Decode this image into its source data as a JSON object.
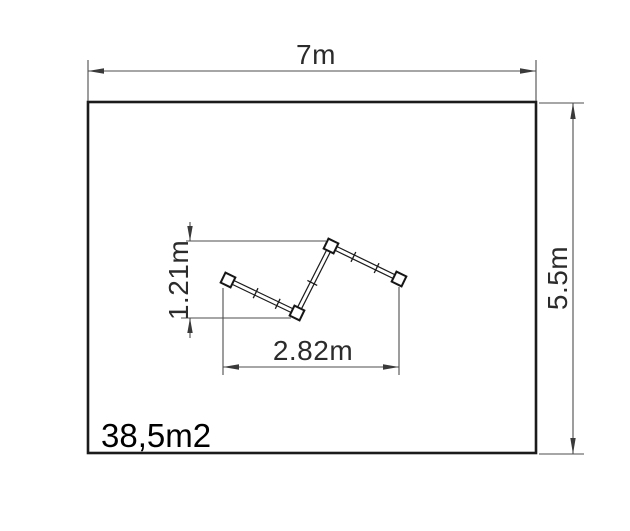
{
  "diagram": {
    "area_label": "38,5m2",
    "dimensions": {
      "outer_width_label": "7m",
      "outer_height_label": "5.5m",
      "item_height_label": "1.21m",
      "item_width_label": "2.82m"
    },
    "colors": {
      "background": "#ffffff",
      "outline": "#1b1b1b",
      "dimension_lines": "#4d4d4d",
      "dimension_text": "#2b2b2b",
      "area_text": "#000000"
    }
  }
}
